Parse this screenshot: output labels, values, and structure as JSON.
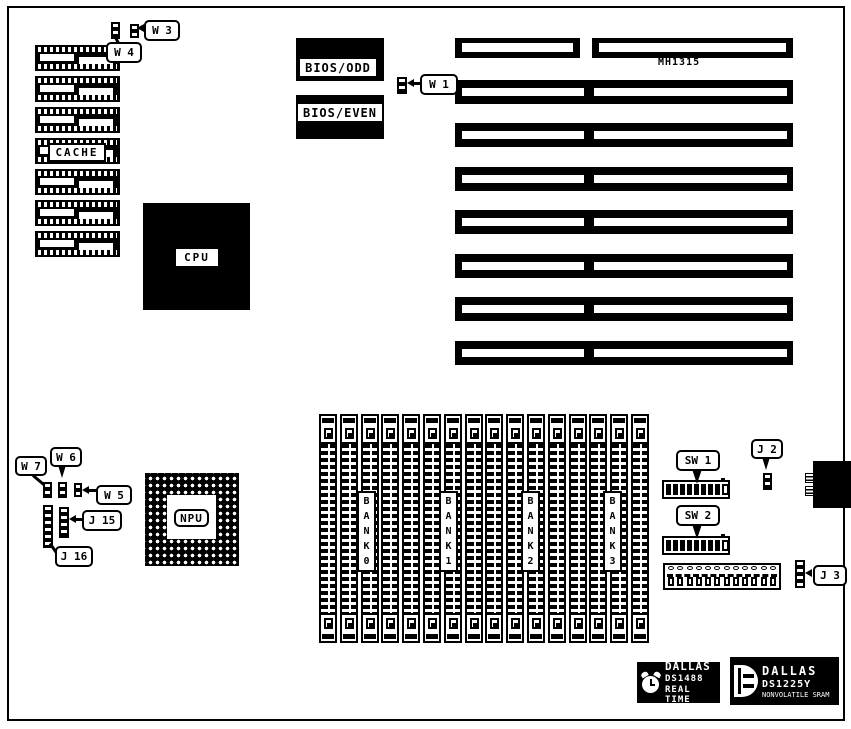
{
  "board": {
    "title": "motherboard-layout-diagram",
    "colors": {
      "foreground": "#000000",
      "background": "#ffffff"
    },
    "cache": {
      "label": "CACHE",
      "chip_rows": 7
    },
    "bios": {
      "odd": "BIOS/ODD",
      "even": "BIOS/EVEN"
    },
    "cpu": {
      "label": "CPU"
    },
    "npu": {
      "label": "NPU"
    },
    "slots": {
      "label": "MH1315",
      "row_count": 8
    },
    "callouts": {
      "w1": "W 1",
      "w3": "W 3",
      "w4": "W 4",
      "w5": "W 5",
      "w6": "W 6",
      "w7": "W 7",
      "j2": "J 2",
      "j3": "J 3",
      "j15": "J 15",
      "j16": "J 16",
      "sw1": "SW 1",
      "sw2": "SW 2"
    },
    "memory": {
      "socket_count": 16,
      "banks": [
        "B\nA\nN\nK\n0",
        "B\nA\nN\nK\n1",
        "B\nA\nN\nK\n2",
        "B\nA\nN\nK\n3"
      ]
    },
    "switches": {
      "sw1_positions": 9,
      "sw2_positions": 9
    },
    "logos": {
      "rtc": {
        "line1": "DALLAS",
        "line2": "DS1488",
        "line3": "REAL TIME"
      },
      "sram": {
        "line1": "DALLAS",
        "line2": "DS1225Y",
        "line3": "NONVOLATILE SRAM"
      }
    }
  }
}
